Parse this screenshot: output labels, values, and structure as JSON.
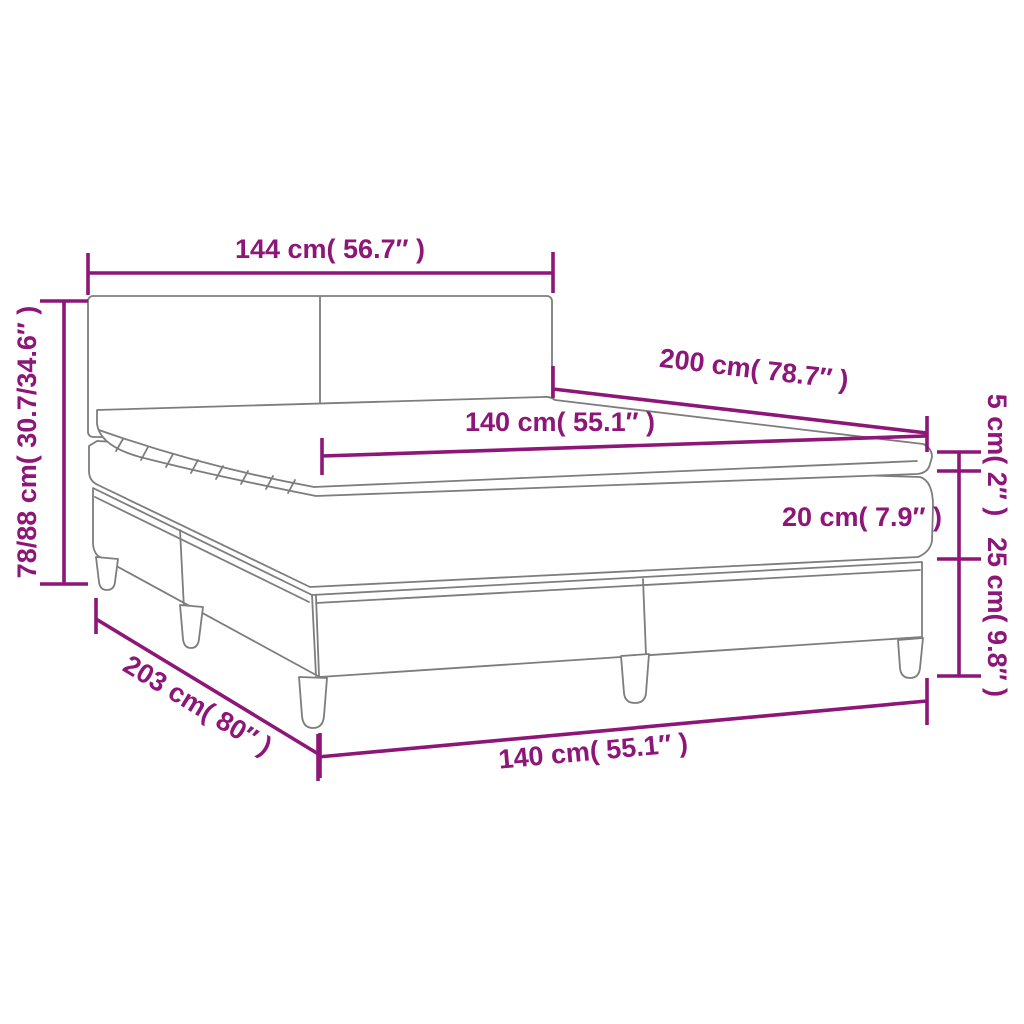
{
  "figure": "box-spring-bed-with-mattress-and-topper",
  "colors": {
    "accent": "#8d1678",
    "outline": "#7d7d7d",
    "background": "#ffffff"
  },
  "dims": {
    "headboard_width": "144 cm( 56.7″ )",
    "total_height": "78/88 cm( 30.7/34.6″ )",
    "bed_length": "200 cm( 78.7″ )",
    "mattress_width_top": "140 cm( 55.1″ )",
    "topper_height": "5 cm( 2″ )",
    "mattress_height": "20 cm( 7.9″ )",
    "base_height": "25 cm( 9.8″ )",
    "base_length": "203 cm( 80″ )",
    "mattress_width_bottom": "140 cm( 55.1″ )"
  }
}
